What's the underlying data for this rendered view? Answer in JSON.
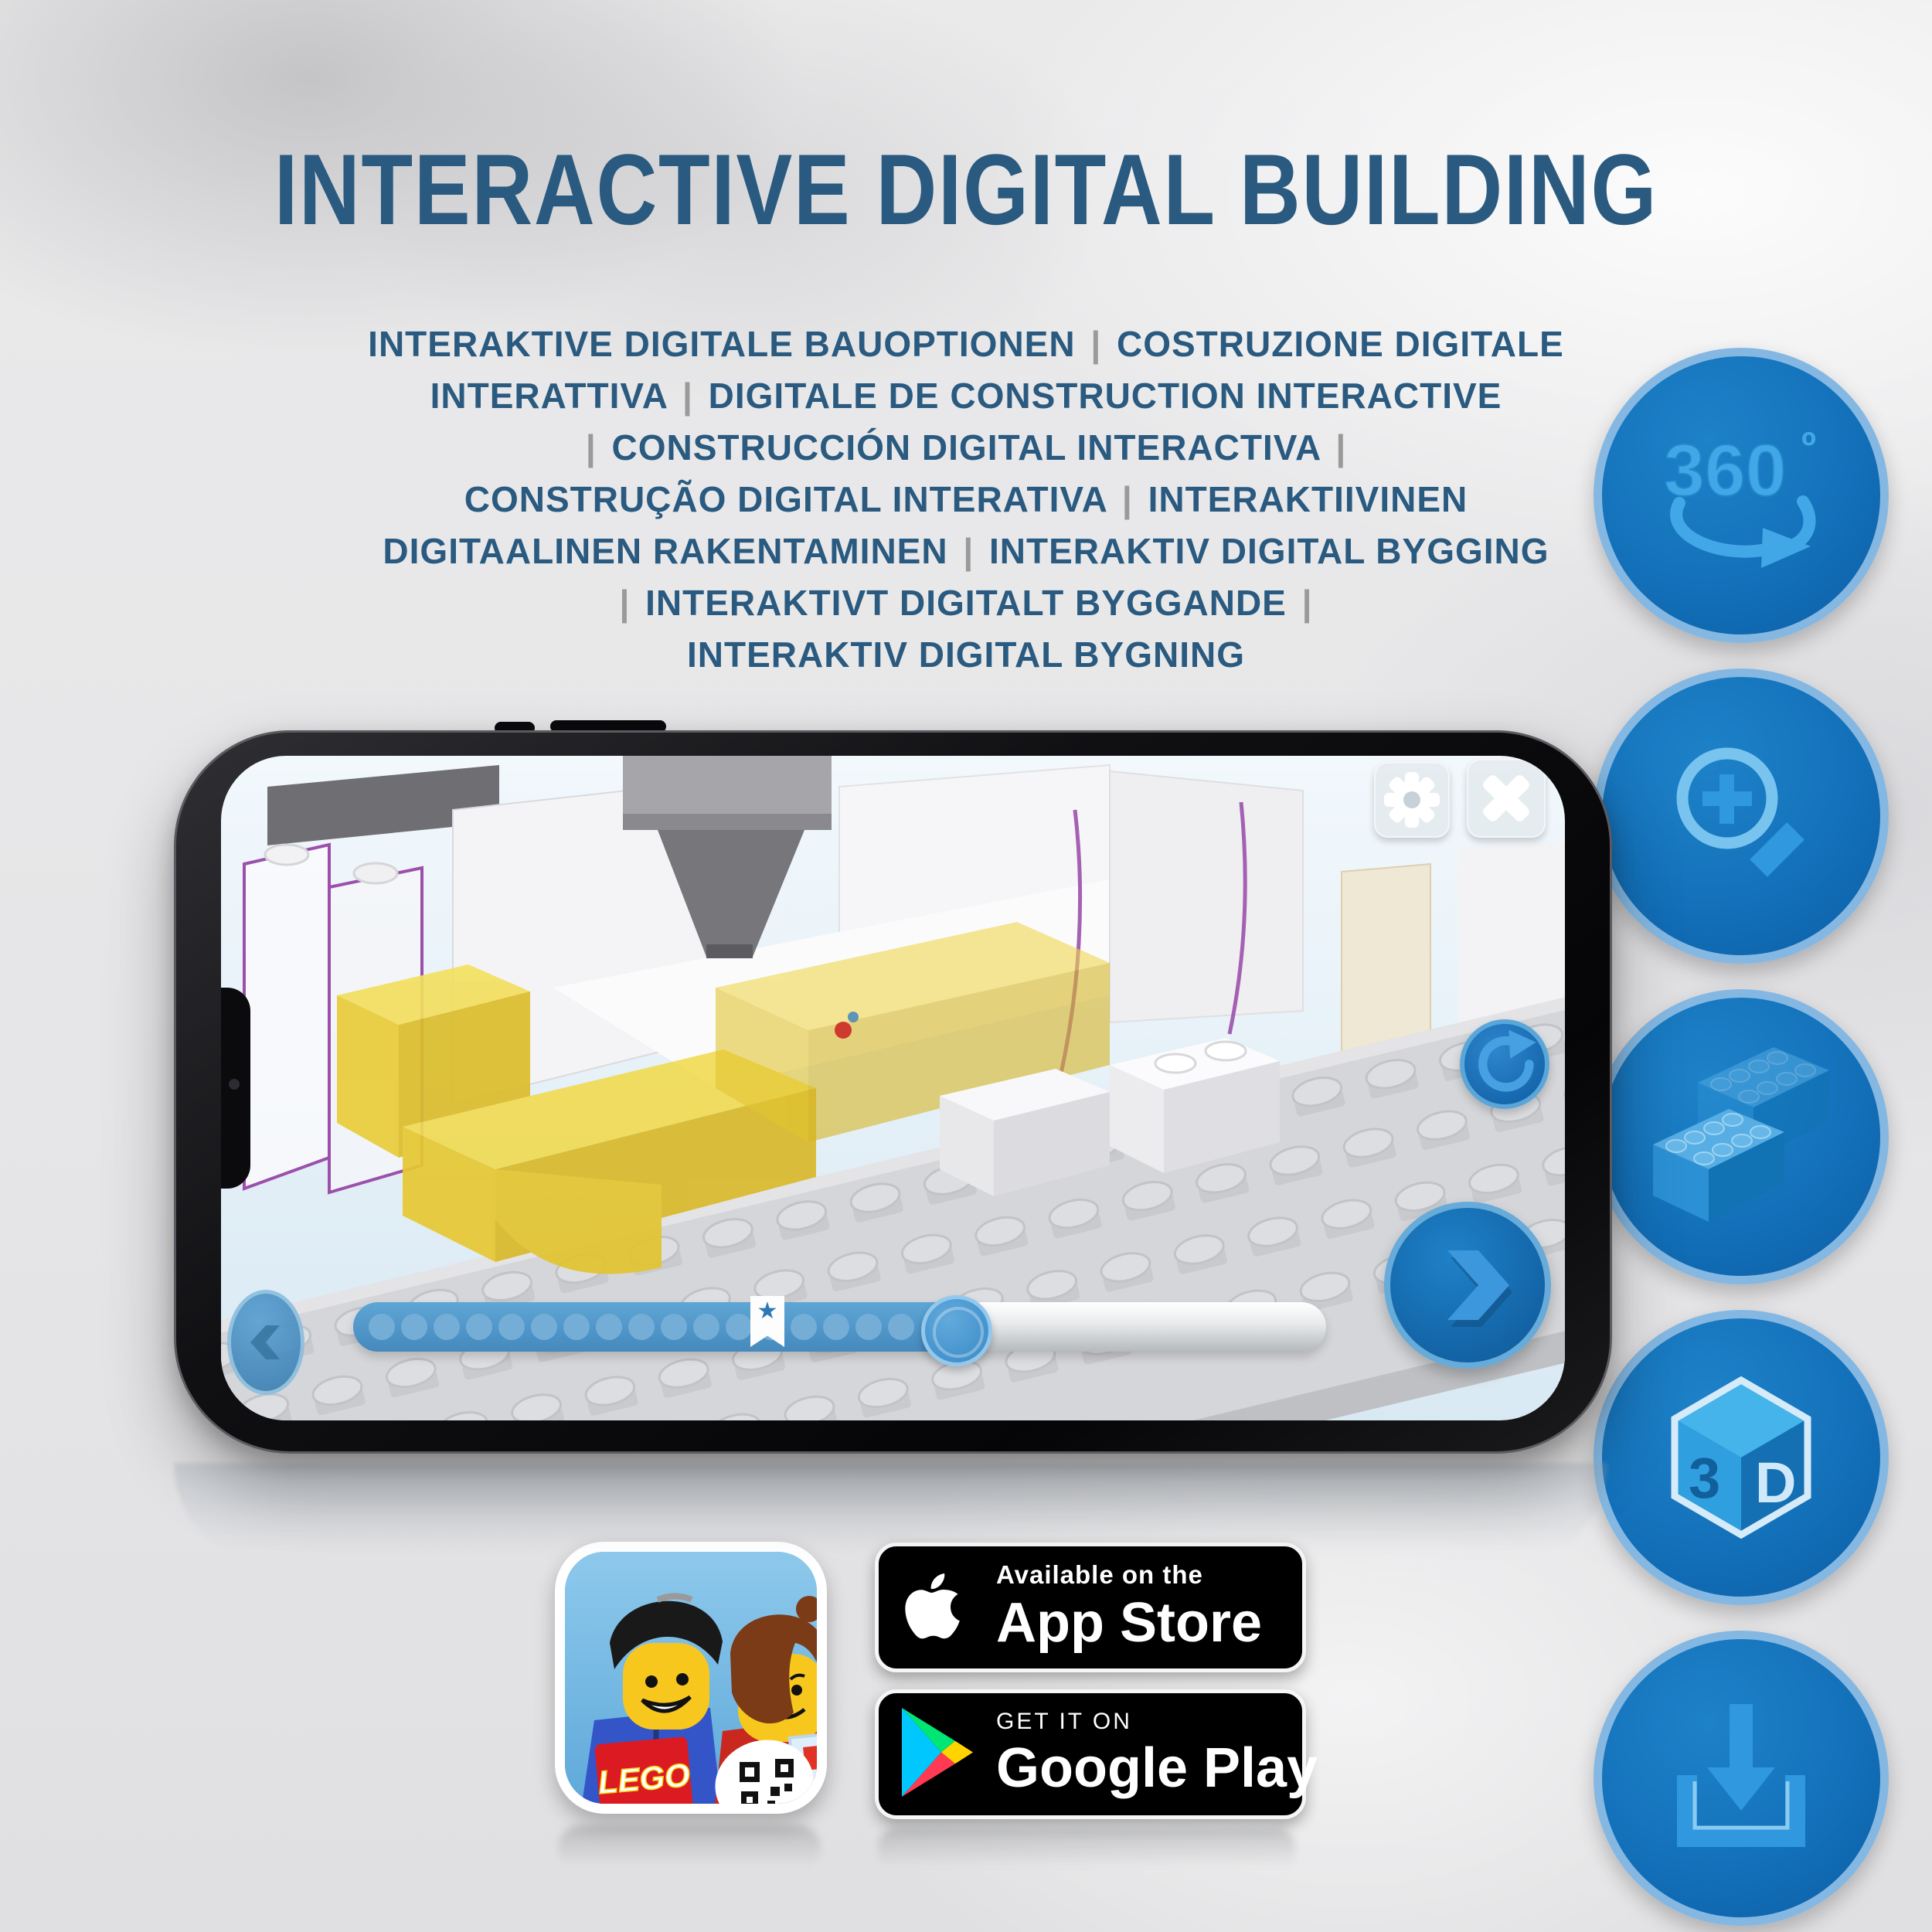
{
  "header": {
    "title": "INTERACTIVE DIGITAL BUILDING",
    "subtitle_lines": [
      "INTERAKTIVE DIGITALE BAUOPTIONEN | COSTRUZIONE DIGITALE",
      "INTERATTIVA | DIGITALE DE CONSTRUCTION INTERACTIVE",
      "| CONSTRUCCIÓN DIGITAL INTERACTIVA |",
      "CONSTRUÇÃO DIGITAL INTERATIVA | INTERAKTIIVINEN",
      "DIGITAALINEN RAKENTAMINEN | INTERAKTIV DIGITAL BYGGING",
      "| INTERAKTIVT DIGITALT BYGGANDE |",
      "INTERAKTIV DIGITAL BYGNING"
    ]
  },
  "phone_app": {
    "settings_button": "gear",
    "close_button": "x",
    "refresh_button": "refresh-arrow",
    "next_button": "chevron-right",
    "prev_button": "chevron-left",
    "progress_bar": {
      "dots_count": 17,
      "bookmark_star": "★",
      "filled_ratio": 0.63,
      "bookmark_ratio": 0.42
    }
  },
  "feature_rail": [
    {
      "id": "rotate-360",
      "label": "360",
      "degree_mark": "º"
    },
    {
      "id": "zoom-in"
    },
    {
      "id": "brick-building"
    },
    {
      "id": "view-3d",
      "left_label": "3",
      "right_label": "D"
    },
    {
      "id": "download"
    }
  ],
  "app_badges": {
    "lego_app_icon": {
      "logo_text": "LEGO"
    },
    "app_store": {
      "tagline": "Available on the",
      "store_name": "App Store"
    },
    "google_play": {
      "tagline": "GET IT ON",
      "store_name": "Google Play"
    }
  },
  "colors": {
    "title_blue": "#2a5a7f",
    "pipe_gray": "#9a9a9a",
    "rail_border": "#84b8e2",
    "accent_blue": "#1371ba",
    "icon_glyph": "#3b9fe0",
    "lego_yellow": "#e9cf3e",
    "purple_outline": "#9b50ac",
    "progress_fill": "#4e97cc"
  }
}
